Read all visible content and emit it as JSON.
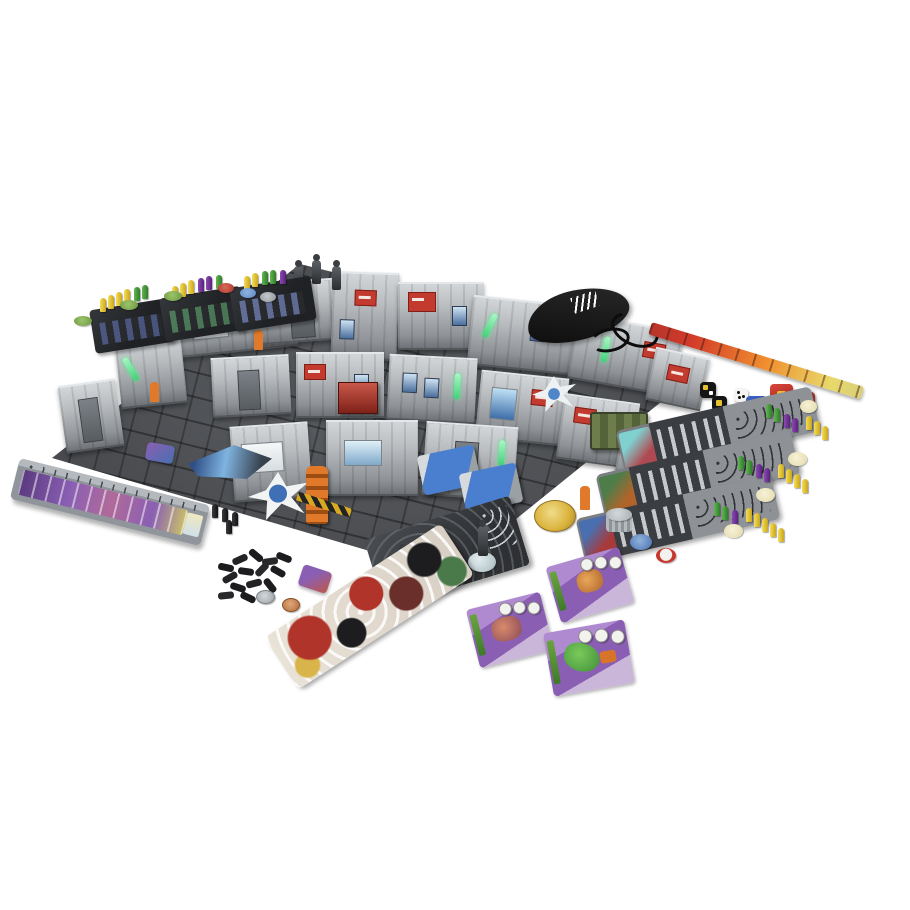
{
  "scene": {
    "type": "product-photo",
    "description": "Overhead product photo of a sci-fi skirmish board game fully set up on a white background: modular terrain board with cardboard walls, miniatures, dashboards, dice, rulers, cards and tokens",
    "background_color": "#ffffff",
    "components": [
      {
        "label": "terrain-board",
        "description": "Large isometric modular sci-fi terrain board with dark tiled floor and grey cardboard wall sections",
        "colors": [
          "#45474b",
          "#b9bdc0",
          "#54575a"
        ]
      },
      {
        "label": "wall-details",
        "description": "Wall decorations: green glow lights, red hazard signs, posters, screens and doors",
        "colors": [
          "#5ee38b",
          "#c33a2e",
          "#4a6f9e"
        ]
      },
      {
        "label": "rooftop-miniatures",
        "description": "Three dark unpainted miniatures standing on top of a rear wall section",
        "count": 3,
        "colors": [
          "#3a3d41"
        ]
      },
      {
        "label": "dice-bag",
        "description": "Black drawstring cloth dice bag with white printed logo and black cord",
        "colors": [
          "#141414",
          "#ffffff"
        ]
      },
      {
        "label": "range-ruler-orange",
        "description": "Long flame-art measuring ruler running diagonally, red-orange fading to yellow",
        "colors": [
          "#d33b2a",
          "#f0902f",
          "#e8d96a"
        ]
      },
      {
        "label": "black-and-white-dice",
        "description": "Two black dice with white and yellow symbols plus one white die with black pips",
        "count": 3,
        "colors": [
          "#151515",
          "#ffffff"
        ]
      },
      {
        "label": "combat-dice",
        "description": "Cluster of one blue and three red dice with yellow geometric symbols",
        "count": 4,
        "colors": [
          "#2b4fb3",
          "#c8352b",
          "#e8c22e"
        ]
      },
      {
        "label": "character-dashboards",
        "description": "Three grey character dashboards with portrait art, slot panels and rows of yellow, green and purple pegs",
        "count": 3,
        "colors": [
          "#8e9296",
          "#e8c832",
          "#3f8f3a",
          "#6a2f8f"
        ]
      },
      {
        "label": "credit-tokens",
        "description": "Small cream round tokens scattered to the right of the dashboards",
        "count": 4,
        "colors": [
          "#f2ecc8"
        ]
      },
      {
        "label": "purple-tracker-ruler",
        "description": "Long grey tracker board with purple artwork strip, a row of peg holes and four black pegs at its end",
        "colors": [
          "#9aa0a4",
          "#7a4f9e",
          "#1c1c1e"
        ]
      },
      {
        "label": "mini-progress-boards",
        "description": "Three small black progress boards at top-left with rows of yellow, green and purple pegs",
        "count": 3,
        "colors": [
          "#2c2e31",
          "#e8c832",
          "#3f8f3a",
          "#6a2f8f"
        ]
      },
      {
        "label": "round-chips-top-left",
        "description": "Small round chips near the mini boards: three green, one red, one blue, one grey",
        "count": 6,
        "colors": [
          "#7fae4c",
          "#c0392b",
          "#5b87c7",
          "#9aa0a4"
        ]
      },
      {
        "label": "black-peg-pile",
        "description": "Loose pile of black plastic pegs",
        "colors": [
          "#1c1c1e"
        ]
      },
      {
        "label": "metal-tokens",
        "description": "One silver and one copper round metallic token",
        "count": 2,
        "colors": [
          "#b9bec2",
          "#c98a52"
        ]
      },
      {
        "label": "crew-display-card",
        "description": "Dark grey display card with hose artwork holding three miniatures on clear round bases",
        "colors": [
          "#3a3d40",
          "#cfd9dc"
        ]
      },
      {
        "label": "art-strip-card",
        "description": "Long rectangular card covered in chaotic red, white and black comic-style artwork",
        "colors": [
          "#b0342a",
          "#f3f0ea",
          "#1d1d1f"
        ]
      },
      {
        "label": "alien-cards",
        "description": "Three purple alien character cards with round stat icons and green edge labels",
        "count": 3,
        "colors": [
          "#8a5fb3",
          "#d98a3a",
          "#4da23f"
        ]
      },
      {
        "label": "gold-coin",
        "description": "Large gold coin token",
        "colors": [
          "#d9b23a"
        ]
      },
      {
        "label": "grey-cylinder-token",
        "description": "Small grey cylindrical token stack",
        "colors": [
          "#9aa0a4"
        ]
      },
      {
        "label": "small-round-tokens",
        "description": "Small blue token and red-ringed white token",
        "count": 2,
        "colors": [
          "#5b87c7",
          "#c8352b"
        ]
      },
      {
        "label": "floor-props",
        "description": "On-board props: blue med-beds, red and green crates, blue ship marker, white drone standees, orange robot and worker figures, hazard stripes",
        "colors": [
          "#4a7fd0",
          "#b0392f",
          "#5a6b3f",
          "#e07a2a"
        ]
      }
    ]
  }
}
